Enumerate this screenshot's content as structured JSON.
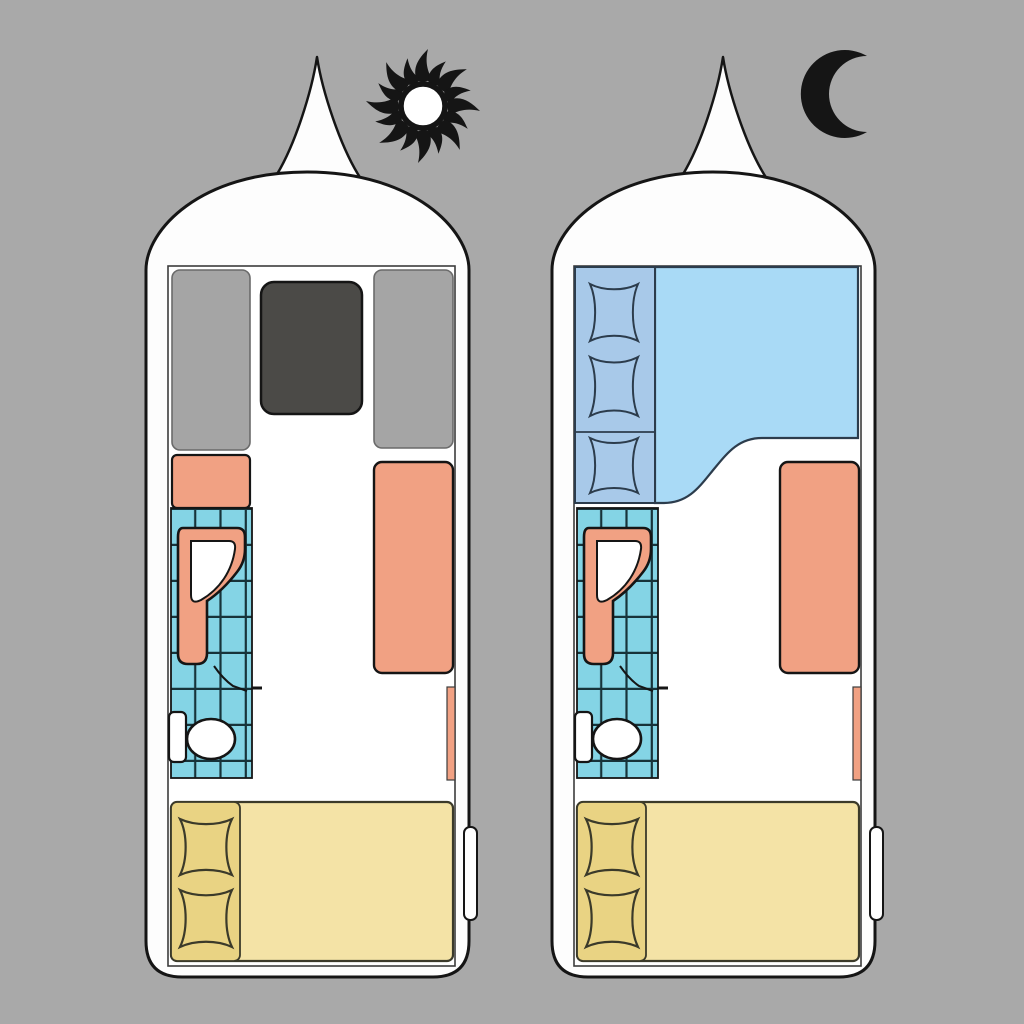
{
  "palette": {
    "background": "#a9a9a9",
    "ink": "#151515",
    "outline_soft": "#3c3c3c",
    "body_white": "#fdfdfd",
    "interior_white": "#ffffff",
    "bench_gray": "#a5a5a5",
    "bench_edge": "#6a6a6a",
    "table_charcoal": "#4b4a47",
    "upholstery_salmon": "#f1a183",
    "tile_blue": "#84d4e5",
    "tile_grid": "#17333a",
    "night_bed_blue": "#a9daf6",
    "night_pillow_blue": "#a8c9e9",
    "night_edge": "#2c3c4c",
    "day_bed_yellow": "#f4e3a6",
    "day_bed_pillow_yellow": "#e9d383",
    "bed_edge": "#3b3a2a",
    "fixture_white": "#ffffff"
  },
  "diagram": {
    "type": "caravan-floorplan-day-night",
    "panels": [
      {
        "mode": "day",
        "badge_icon": "sun-icon",
        "furniture": [
          "hitch-cone",
          "dinette-bench-left",
          "dinette-table",
          "dinette-bench-right",
          "kitchen-counter",
          "shower-room",
          "washbasin",
          "shower-door-swing",
          "toilet-cistern",
          "toilet-bowl",
          "side-sofa",
          "wall-shelf",
          "fixed-bed",
          "pillow",
          "pillow",
          "entry-door-handle"
        ]
      },
      {
        "mode": "night",
        "badge_icon": "moon-icon",
        "furniture": [
          "hitch-cone",
          "converted-double-bed",
          "pillow",
          "pillow",
          "pillow",
          "shower-room",
          "washbasin",
          "shower-door-swing",
          "toilet-cistern",
          "toilet-bowl",
          "side-sofa",
          "wall-shelf",
          "fixed-bed",
          "pillow",
          "pillow",
          "entry-door-handle"
        ]
      }
    ]
  }
}
